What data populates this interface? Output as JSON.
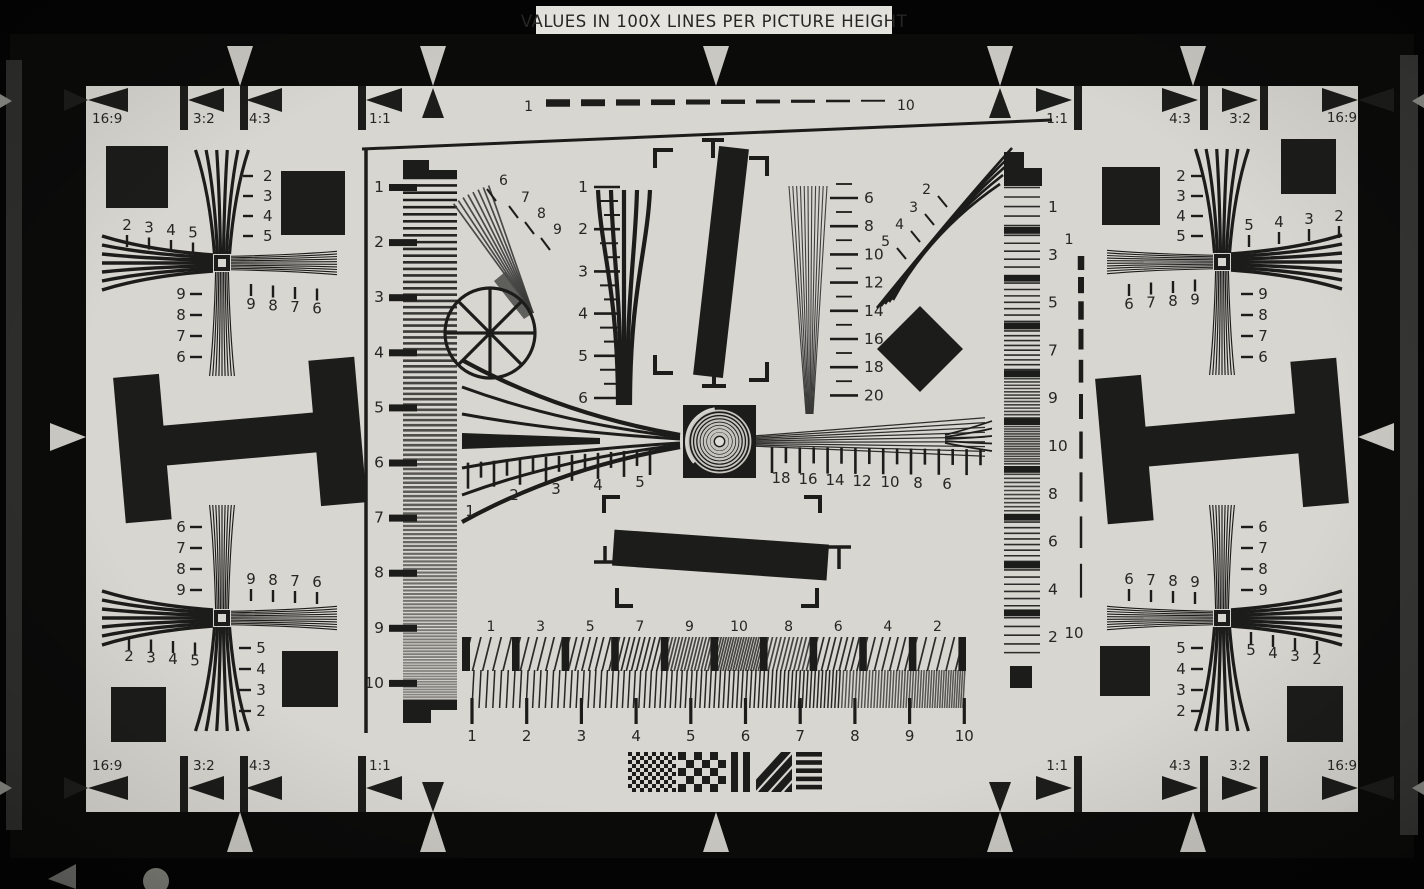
{
  "banner": {
    "text": "VALUES IN 100X LINES PER PICTURE HEIGHT"
  },
  "colors": {
    "background": "#040404",
    "band": "#0b0b0a",
    "face": "#d8d6d0",
    "ink": "#1c1c1a",
    "text": "#262624",
    "soft_gray": "#3c3c3a",
    "marker_light": "#cac8c2",
    "banner_bg": "#e6e4df"
  },
  "aspect_markers": {
    "top_left": [
      "16:9",
      "3:2",
      "4:3",
      "1:1"
    ],
    "top_right": [
      "1:1",
      "4:3",
      "3:2",
      "16:9"
    ],
    "bottom_left": [
      "16:9",
      "3:2",
      "4:3",
      "1:1"
    ],
    "bottom_right": [
      "1:1",
      "4:3",
      "3:2",
      "16:9"
    ]
  },
  "top_dash_scale": {
    "left_label": "1",
    "right_label": "10"
  },
  "left_column_scale": {
    "labels": [
      "1",
      "2",
      "3",
      "4",
      "5",
      "6",
      "7",
      "8",
      "9",
      "10"
    ]
  },
  "right_block_column": {
    "labels": [
      "1",
      "3",
      "5",
      "7",
      "9",
      "10",
      "8",
      "6",
      "4",
      "2"
    ]
  },
  "right_dash_scale": {
    "top_label": "1",
    "bottom_label": "10"
  },
  "corner_clusters": {
    "top_left": {
      "upper_arm": [
        "2",
        "3",
        "4",
        "5"
      ],
      "outer_arm": [
        "2",
        "3",
        "4",
        "5"
      ],
      "lower_arm": [
        "9",
        "8",
        "7",
        "6"
      ],
      "inner_ticks": [
        "9",
        "8",
        "7",
        "6"
      ]
    },
    "top_right": {
      "upper_arm": [
        "2",
        "3",
        "4",
        "5"
      ],
      "outer_arm": [
        "5",
        "4",
        "3",
        "2"
      ],
      "lower_arm": [
        "9",
        "8",
        "7",
        "6"
      ],
      "inner_ticks": [
        "6",
        "7",
        "8",
        "9"
      ]
    },
    "bottom_left": {
      "upper_arm": [
        "6",
        "7",
        "8",
        "9"
      ],
      "outer_arm": [
        "2",
        "3",
        "4",
        "5"
      ],
      "lower_arm": [
        "5",
        "4",
        "3",
        "2"
      ],
      "inner_ticks": [
        "9",
        "8",
        "7",
        "6"
      ]
    },
    "bottom_right": {
      "upper_arm": [
        "6",
        "7",
        "8",
        "9"
      ],
      "outer_arm": [
        "5",
        "4",
        "3",
        "2"
      ],
      "lower_arm": [
        "5",
        "4",
        "3",
        "2"
      ],
      "inner_ticks": [
        "6",
        "7",
        "8",
        "9"
      ]
    }
  },
  "center": {
    "diagonal_wedge_labels": [
      "6",
      "7",
      "8",
      "9"
    ],
    "vertical_wedge_scale": [
      "1",
      "2",
      "3",
      "4",
      "5",
      "6"
    ],
    "fine_wedge_scale": [
      "6",
      "8",
      "10",
      "12",
      "14",
      "16",
      "18",
      "20"
    ],
    "curved_wedge_labels": [
      "2",
      "3",
      "4",
      "5"
    ],
    "sweep_left_scale": [
      "1",
      "2",
      "3",
      "4",
      "5"
    ],
    "sweep_right_scale": [
      "18",
      "16",
      "14",
      "12",
      "10",
      "8",
      "6"
    ],
    "block_row_labels": [
      "1",
      "3",
      "5",
      "7",
      "9",
      "10",
      "8",
      "6",
      "4",
      "2"
    ],
    "bottom_sweep_scale": [
      "1",
      "2",
      "3",
      "4",
      "5",
      "6",
      "7",
      "8",
      "9",
      "10"
    ]
  }
}
